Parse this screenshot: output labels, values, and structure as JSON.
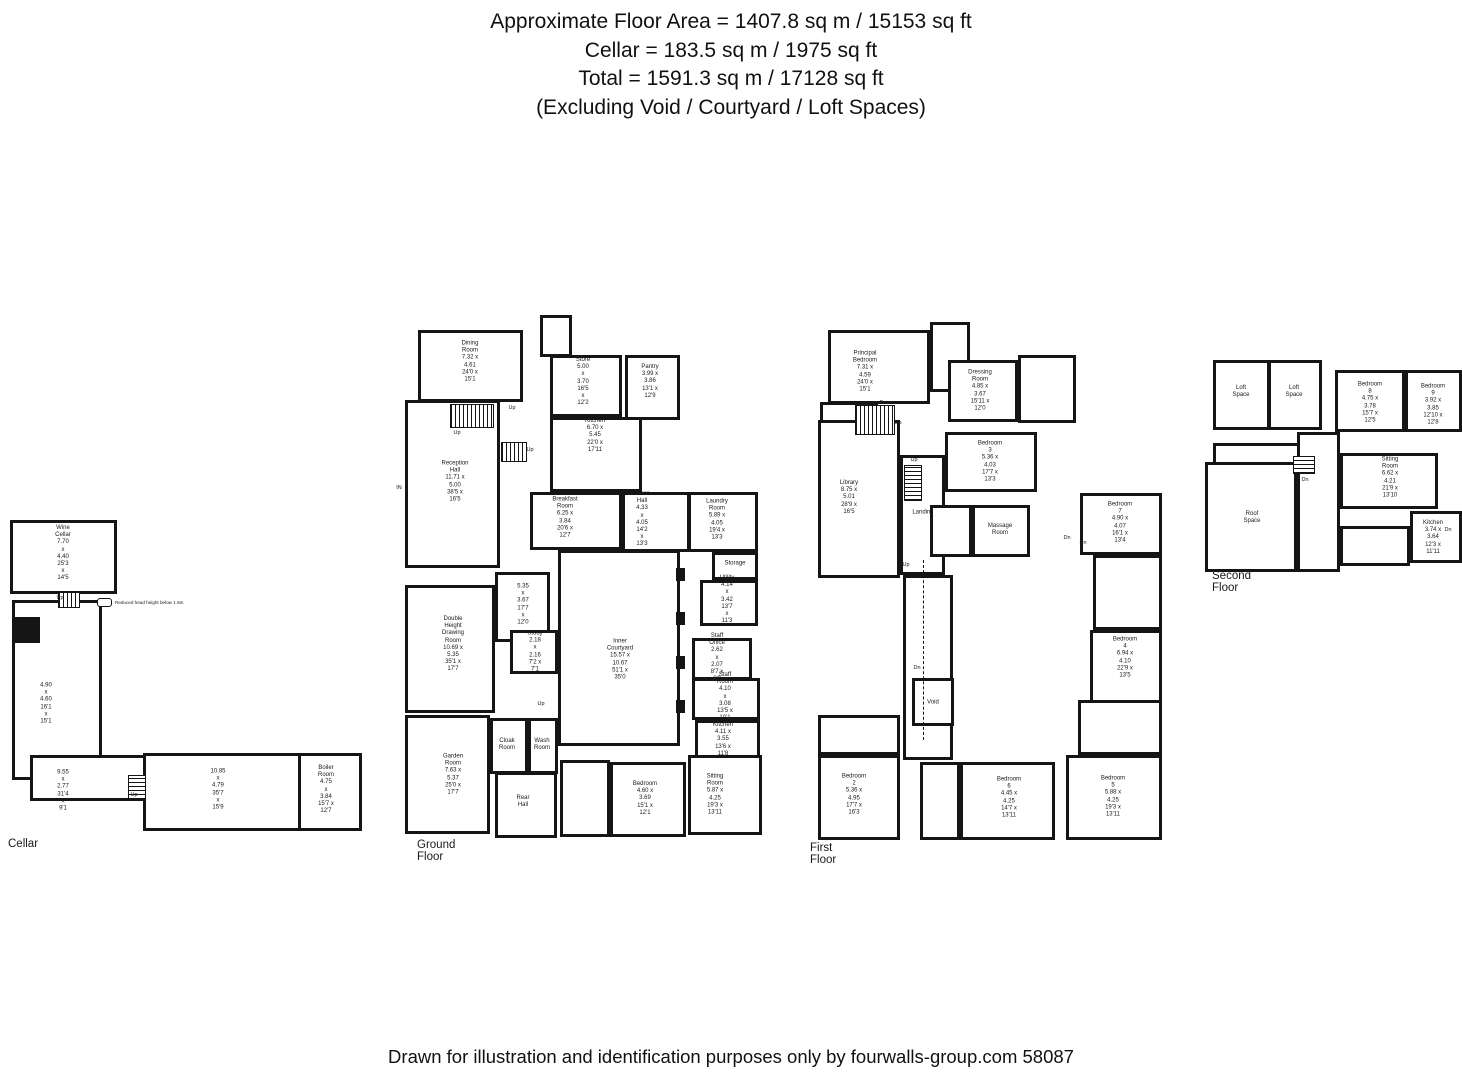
{
  "header": {
    "lines": [
      "Approximate Floor Area = 1407.8 sq m / 15153 sq ft",
      "Cellar = 183.5 sq m / 1975 sq ft",
      "Total = 1591.3 sq m / 17128 sq ft",
      "(Excluding Void / Courtyard / Loft Spaces)"
    ]
  },
  "footer": {
    "text": "Drawn for illustration and identification purposes only by fourwalls-group.com 58087"
  },
  "legend": {
    "text": "Reduced head height below 1.5m"
  },
  "colors": {
    "ink": "#151515",
    "paper": "#ffffff"
  },
  "floors": [
    {
      "id": "cellar",
      "label": "Cellar",
      "origin": {
        "x": 8,
        "y": 518
      },
      "label_pos": {
        "x": 0,
        "y": 320
      },
      "rooms": [
        {
          "name": "Wine Cellar",
          "metric": "7.70 x 4.40",
          "imperial": "25'3 x 14'5",
          "rect": {
            "x": 2,
            "y": 2,
            "w": 107,
            "h": 74
          },
          "lx": 55,
          "ly": 36
        },
        {
          "metric": "4.90 x 4.60",
          "imperial": "16'1 x 15'1",
          "rect": {
            "x": 4,
            "y": 82,
            "w": 90,
            "h": 180
          },
          "lx": 38,
          "ly": 186
        },
        {
          "metric": "9.55 x 2.77",
          "imperial": "31'4 x 9'1",
          "rect": {
            "x": 22,
            "y": 237,
            "w": 122,
            "h": 46
          },
          "lx": 55,
          "ly": 273
        },
        {
          "metric": "10.85 x 4.79",
          "imperial": "35'7 x 15'9",
          "rect": {
            "x": 135,
            "y": 235,
            "w": 162,
            "h": 78
          },
          "lx": 210,
          "ly": 272
        },
        {
          "name": "Boiler Room",
          "metric": "4.75 x 3.84",
          "imperial": "15'7 x 12'7",
          "rect": {
            "x": 290,
            "y": 235,
            "w": 64,
            "h": 78
          },
          "lx": 318,
          "ly": 272
        }
      ],
      "solids": [
        {
          "x": 4,
          "y": 99,
          "w": 28,
          "h": 26
        }
      ],
      "stairs": [
        {
          "x": 50,
          "y": 74,
          "w": 22,
          "h": 16,
          "dir": "h"
        },
        {
          "x": 120,
          "y": 257,
          "w": 18,
          "h": 25,
          "dir": "v"
        }
      ],
      "annotations": [
        {
          "text": "Up",
          "x": 52,
          "y": 80
        },
        {
          "text": "Up",
          "x": 126,
          "y": 277
        }
      ]
    },
    {
      "id": "ground-floor",
      "label": "Ground Floor",
      "origin": {
        "x": 395,
        "y": 312
      },
      "label_pos": {
        "x": 22,
        "y": 527
      },
      "rooms": [
        {
          "name": "Dining Room",
          "metric": "7.32 x 4.61",
          "imperial": "24'0 x 15'1",
          "rect": {
            "x": 23,
            "y": 18,
            "w": 105,
            "h": 72
          },
          "lx": 75,
          "ly": 50
        },
        {
          "rect": {
            "x": 145,
            "y": 3,
            "w": 32,
            "h": 42
          }
        },
        {
          "name": "Store",
          "metric": "5.00 x 3.70",
          "imperial": "16'5 x 12'2",
          "rect": {
            "x": 155,
            "y": 43,
            "w": 72,
            "h": 62
          },
          "lx": 188,
          "ly": 70
        },
        {
          "name": "Pantry",
          "metric": "3.99 x 3.86",
          "imperial": "13'1 x 12'9",
          "rect": {
            "x": 230,
            "y": 43,
            "w": 55,
            "h": 65
          },
          "lx": 255,
          "ly": 70
        },
        {
          "name": "Kitchen",
          "metric": "6.70 x 5.45",
          "imperial": "22'0 x 17'11",
          "rect": {
            "x": 155,
            "y": 105,
            "w": 92,
            "h": 75
          },
          "lx": 200,
          "ly": 124
        },
        {
          "name": "Reception Hall",
          "metric": "11.71 x 5.00",
          "imperial": "38'5 x 16'5",
          "rect": {
            "x": 10,
            "y": 88,
            "w": 95,
            "h": 168
          },
          "lx": 60,
          "ly": 170
        },
        {
          "name": "Breakfast Room",
          "metric": "6.25 x 3.84",
          "imperial": "20'6 x 12'7",
          "rect": {
            "x": 135,
            "y": 180,
            "w": 92,
            "h": 58
          },
          "lx": 170,
          "ly": 206
        },
        {
          "name": "Inner Hall",
          "metric": "4.33 x 4.05",
          "imperial": "14'2 x 13'3",
          "rect": {
            "x": 227,
            "y": 180,
            "w": 68,
            "h": 60
          },
          "lx": 247,
          "ly": 208
        },
        {
          "name": "Laundry Room",
          "metric": "5.89 x 4.05",
          "imperial": "19'4 x 13'3",
          "rect": {
            "x": 293,
            "y": 180,
            "w": 70,
            "h": 60
          },
          "lx": 322,
          "ly": 208
        },
        {
          "name": "Storage",
          "rect": {
            "x": 317,
            "y": 240,
            "w": 46,
            "h": 28
          },
          "lx": 340,
          "ly": 252
        },
        {
          "name": "Utility",
          "metric": "4.14 x 3.42",
          "imperial": "13'7 x 11'3",
          "rect": {
            "x": 305,
            "y": 268,
            "w": 58,
            "h": 46
          },
          "lx": 332,
          "ly": 288
        },
        {
          "metric": "5.35 x 3.67",
          "imperial": "17'7 x 12'0",
          "rect": {
            "x": 100,
            "y": 260,
            "w": 55,
            "h": 70
          },
          "lx": 128,
          "ly": 293
        },
        {
          "name": "Double Height\nDrawing Room",
          "metric": "10.69 x 5.35",
          "imperial": "35'1 x 17'7",
          "rect": {
            "x": 10,
            "y": 273,
            "w": 90,
            "h": 128
          },
          "lx": 58,
          "ly": 333
        },
        {
          "name": "Study",
          "metric": "2.18 x 2.16",
          "imperial": "7'2 x 7'1",
          "rect": {
            "x": 115,
            "y": 318,
            "w": 48,
            "h": 44
          },
          "lx": 140,
          "ly": 340
        },
        {
          "name": "Inner Courtyard",
          "metric": "15.57 x 10.67",
          "imperial": "51'1 x 35'0",
          "rect": {
            "x": 163,
            "y": 238,
            "w": 122,
            "h": 196
          },
          "lx": 225,
          "ly": 348
        },
        {
          "name": "Staff Office",
          "metric": "2.62 x 2.07",
          "imperial": "8'7 x 6'9",
          "rect": {
            "x": 297,
            "y": 326,
            "w": 60,
            "h": 42
          },
          "lx": 322,
          "ly": 346
        },
        {
          "name": "Staff Room",
          "metric": "4.10 x 3.08",
          "imperial": "13'5 x 10'1",
          "rect": {
            "x": 297,
            "y": 366,
            "w": 68,
            "h": 42
          },
          "lx": 330,
          "ly": 385
        },
        {
          "name": "Kitchen",
          "metric": "4.11 x 3.55",
          "imperial": "13'6 x 11'8",
          "rect": {
            "x": 300,
            "y": 408,
            "w": 65,
            "h": 44
          },
          "lx": 328,
          "ly": 428
        },
        {
          "name": "Cloak\nRoom",
          "rect": {
            "x": 95,
            "y": 406,
            "w": 38,
            "h": 56
          },
          "lx": 112,
          "ly": 433
        },
        {
          "name": "Wash\nRoom",
          "rect": {
            "x": 133,
            "y": 406,
            "w": 30,
            "h": 56
          },
          "lx": 147,
          "ly": 433
        },
        {
          "name": "Garden Room",
          "metric": "7.63 x 5.37",
          "imperial": "25'0 x 17'7",
          "rect": {
            "x": 10,
            "y": 403,
            "w": 85,
            "h": 119
          },
          "lx": 58,
          "ly": 463
        },
        {
          "name": "Rear\nHall",
          "rect": {
            "x": 100,
            "y": 460,
            "w": 62,
            "h": 66
          },
          "lx": 128,
          "ly": 490
        },
        {
          "rect": {
            "x": 165,
            "y": 448,
            "w": 50,
            "h": 77
          }
        },
        {
          "name": "Bedroom",
          "metric": "4.60 x 3.69",
          "imperial": "15'1 x 12'1",
          "rect": {
            "x": 215,
            "y": 450,
            "w": 76,
            "h": 75
          },
          "lx": 250,
          "ly": 487
        },
        {
          "name": "Sitting Room",
          "metric": "5.87 x 4.25",
          "imperial": "19'3 x 13'11",
          "rect": {
            "x": 293,
            "y": 443,
            "w": 74,
            "h": 80
          },
          "lx": 320,
          "ly": 483
        }
      ],
      "solids": [
        {
          "x": 281,
          "y": 256,
          "w": 9,
          "h": 13
        },
        {
          "x": 281,
          "y": 300,
          "w": 9,
          "h": 13
        },
        {
          "x": 281,
          "y": 344,
          "w": 9,
          "h": 13
        },
        {
          "x": 281,
          "y": 388,
          "w": 9,
          "h": 13
        }
      ],
      "stairs": [
        {
          "x": 55,
          "y": 92,
          "w": 44,
          "h": 24,
          "dir": "h"
        },
        {
          "x": 106,
          "y": 130,
          "w": 26,
          "h": 20,
          "dir": "h"
        }
      ],
      "annotations": [
        {
          "text": "Up",
          "x": 117,
          "y": 96
        },
        {
          "text": "Up",
          "x": 62,
          "y": 121
        },
        {
          "text": "Up",
          "x": 135,
          "y": 138
        },
        {
          "text": "Up",
          "x": 146,
          "y": 392
        },
        {
          "text": "IN",
          "x": 4,
          "y": 176
        }
      ]
    },
    {
      "id": "first-floor",
      "label": "First Floor",
      "origin": {
        "x": 808,
        "y": 315
      },
      "label_pos": {
        "x": 2,
        "y": 527
      },
      "rooms": [
        {
          "name": "Principal Bedroom",
          "metric": "7.31 x 4.59",
          "imperial": "24'0 x 15'1",
          "rect": {
            "x": 20,
            "y": 15,
            "w": 102,
            "h": 74
          },
          "lx": 57,
          "ly": 57
        },
        {
          "rect": {
            "x": 122,
            "y": 7,
            "w": 40,
            "h": 70
          }
        },
        {
          "name": "Dressing Room",
          "metric": "4.85 x 3.67",
          "imperial": "15'11 x 12'0",
          "rect": {
            "x": 140,
            "y": 45,
            "w": 70,
            "h": 62
          },
          "lx": 172,
          "ly": 76
        },
        {
          "rect": {
            "x": 210,
            "y": 40,
            "w": 58,
            "h": 68
          }
        },
        {
          "name": "Landing",
          "rect": {
            "x": 12,
            "y": 87,
            "w": 58,
            "h": 55
          },
          "lx": 36,
          "ly": 121
        },
        {
          "name": "Bedroom 3",
          "metric": "5.36 x 4.03",
          "imperial": "17'7 x 13'3",
          "rect": {
            "x": 137,
            "y": 117,
            "w": 92,
            "h": 60
          },
          "lx": 182,
          "ly": 147
        },
        {
          "name": "Library",
          "metric": "8.75 x 5.01",
          "imperial": "28'9 x 16'5",
          "rect": {
            "x": 10,
            "y": 105,
            "w": 82,
            "h": 158
          },
          "lx": 41,
          "ly": 183
        },
        {
          "name": "Landing",
          "rect": {
            "x": 92,
            "y": 140,
            "w": 45,
            "h": 120
          },
          "lx": 115,
          "ly": 198
        },
        {
          "rect": {
            "x": 122,
            "y": 190,
            "w": 42,
            "h": 52
          }
        },
        {
          "name": "Massage\nRoom",
          "rect": {
            "x": 164,
            "y": 190,
            "w": 58,
            "h": 52
          },
          "lx": 192,
          "ly": 215
        },
        {
          "name": "Bedroom 7",
          "metric": "4.90 x 4.07",
          "imperial": "16'1 x 13'4",
          "rect": {
            "x": 272,
            "y": 178,
            "w": 82,
            "h": 62
          },
          "lx": 312,
          "ly": 208
        },
        {
          "rect": {
            "x": 285,
            "y": 240,
            "w": 69,
            "h": 75
          }
        },
        {
          "name": "Bedroom 4",
          "metric": "6.94 x 4.10",
          "imperial": "22'9 x 13'5",
          "rect": {
            "x": 282,
            "y": 315,
            "w": 72,
            "h": 75
          },
          "lx": 317,
          "ly": 343
        },
        {
          "rect": {
            "x": 95,
            "y": 260,
            "w": 50,
            "h": 185
          }
        },
        {
          "name": "Void",
          "rect": {
            "x": 104,
            "y": 363,
            "w": 42,
            "h": 48
          },
          "lx": 125,
          "ly": 388
        },
        {
          "rect": {
            "x": 10,
            "y": 400,
            "w": 82,
            "h": 40
          }
        },
        {
          "name": "Bedroom 2",
          "metric": "5.36 x 4.95",
          "imperial": "17'7 x 16'3",
          "rect": {
            "x": 10,
            "y": 440,
            "w": 82,
            "h": 85
          },
          "lx": 46,
          "ly": 480
        },
        {
          "rect": {
            "x": 112,
            "y": 447,
            "w": 40,
            "h": 78
          }
        },
        {
          "name": "Bedroom 6",
          "metric": "4.45 x 4.25",
          "imperial": "14'7 x 13'11",
          "rect": {
            "x": 152,
            "y": 447,
            "w": 95,
            "h": 78
          },
          "lx": 201,
          "ly": 483
        },
        {
          "rect": {
            "x": 270,
            "y": 385,
            "w": 84,
            "h": 55
          }
        },
        {
          "name": "Bedroom 5",
          "metric": "5.88 x 4.25",
          "imperial": "19'3 x 13'11",
          "rect": {
            "x": 258,
            "y": 440,
            "w": 96,
            "h": 85
          },
          "lx": 305,
          "ly": 482
        }
      ],
      "solids": [],
      "stairs": [
        {
          "x": 47,
          "y": 90,
          "w": 40,
          "h": 30,
          "dir": "h"
        },
        {
          "x": 96,
          "y": 150,
          "w": 18,
          "h": 36,
          "dir": "v"
        }
      ],
      "lines": [
        {
          "x": 115,
          "y": 245,
          "h": 180
        }
      ],
      "annotations": [
        {
          "text": "Dn",
          "x": 75,
          "y": 88
        },
        {
          "text": "Up",
          "x": 90,
          "y": 108
        },
        {
          "text": "Up",
          "x": 106,
          "y": 145
        },
        {
          "text": "Dn",
          "x": 259,
          "y": 223
        },
        {
          "text": "Dn",
          "x": 275,
          "y": 228
        },
        {
          "text": "Dn",
          "x": 109,
          "y": 353
        },
        {
          "text": "Up",
          "x": 98,
          "y": 250
        }
      ]
    },
    {
      "id": "second-floor",
      "label": "Second Floor",
      "origin": {
        "x": 1205,
        "y": 348
      },
      "label_pos": {
        "x": 7,
        "y": 222
      },
      "rooms": [
        {
          "name": "Loft\nSpace",
          "rect": {
            "x": 8,
            "y": 12,
            "w": 57,
            "h": 70
          },
          "lx": 36,
          "ly": 44
        },
        {
          "name": "Loft\nSpace",
          "rect": {
            "x": 63,
            "y": 12,
            "w": 54,
            "h": 70
          },
          "lx": 89,
          "ly": 44
        },
        {
          "name": "Eaves",
          "rect": {
            "x": 8,
            "y": 95,
            "w": 110,
            "h": 28
          },
          "lx": 37,
          "ly": 118
        },
        {
          "name": "Roof\nSpace",
          "rect": {
            "x": 0,
            "y": 114,
            "w": 92,
            "h": 110
          },
          "lx": 47,
          "ly": 170
        },
        {
          "name": "Bedroom 8",
          "metric": "4.75 x 3.78",
          "imperial": "15'7 x 12'5",
          "rect": {
            "x": 130,
            "y": 22,
            "w": 70,
            "h": 62
          },
          "lx": 165,
          "ly": 55
        },
        {
          "name": "Bedroom 9",
          "metric": "3.92 x 3.85",
          "imperial": "12'10 x 12'8",
          "rect": {
            "x": 200,
            "y": 22,
            "w": 57,
            "h": 62
          },
          "lx": 228,
          "ly": 57
        },
        {
          "rect": {
            "x": 92,
            "y": 84,
            "w": 43,
            "h": 140
          }
        },
        {
          "name": "Sitting Room",
          "metric": "6.62 x 4.21",
          "imperial": "21'9 x 13'10",
          "rect": {
            "x": 135,
            "y": 105,
            "w": 98,
            "h": 56
          },
          "lx": 185,
          "ly": 130
        },
        {
          "rect": {
            "x": 135,
            "y": 178,
            "w": 70,
            "h": 40
          }
        },
        {
          "name": "Kitchen",
          "metric": "3.74 x 3.64",
          "imperial": "12'3 x 11'11",
          "rect": {
            "x": 205,
            "y": 163,
            "w": 52,
            "h": 52
          },
          "lx": 228,
          "ly": 190
        }
      ],
      "solids": [],
      "stairs": [
        {
          "x": 88,
          "y": 108,
          "w": 22,
          "h": 18,
          "dir": "v"
        }
      ],
      "annotations": [
        {
          "text": "Dn",
          "x": 100,
          "y": 132
        },
        {
          "text": "Dn",
          "x": 243,
          "y": 182
        }
      ]
    }
  ]
}
